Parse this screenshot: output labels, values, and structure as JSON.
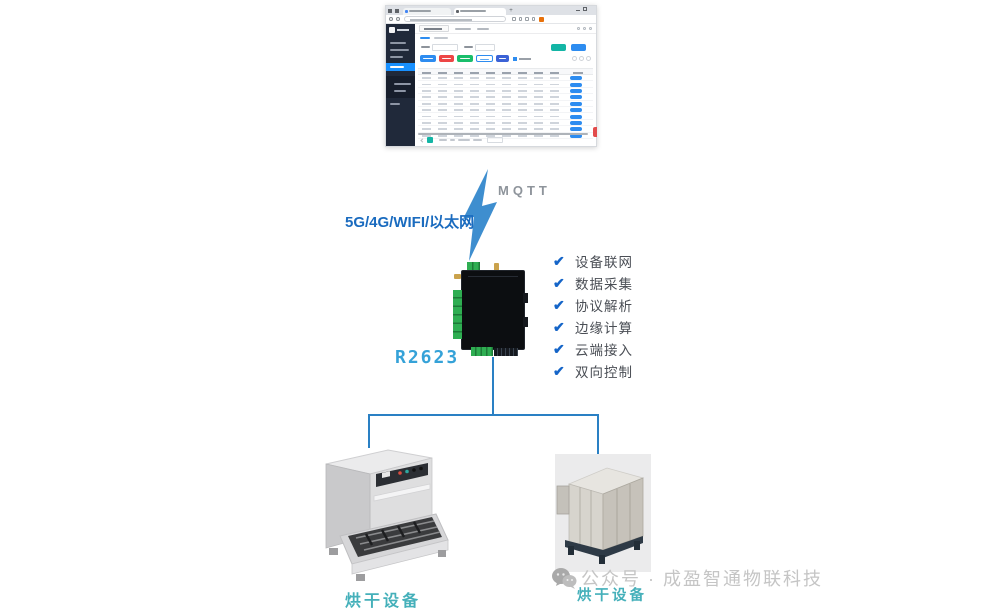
{
  "connection": {
    "protocol_label": "MQTT",
    "link_label": "5G/4G/WIFI/以太网"
  },
  "gateway": {
    "model": "R2623",
    "features": [
      "设备联网",
      "数据采集",
      "协议解析",
      "边缘计算",
      "云端接入",
      "双向控制"
    ]
  },
  "devices": {
    "left_label": "烘干设备",
    "right_label": "烘干设备"
  },
  "watermark": {
    "text": "公众号 · 成盈智通物联科技"
  },
  "icons": {
    "lightning": "lightning-bolt-icon",
    "check": "check-icon",
    "wechat": "wechat-icon"
  },
  "colors": {
    "connector_blue": "#2a80c4",
    "link_label_blue": "#1a6bbf",
    "mqtt_gray": "#8e949b",
    "check_blue": "#1565c8",
    "feature_text": "#4a4e55",
    "gateway_label_blue": "#35a2d8",
    "device_label_teal": "#45b0ba",
    "watermark_gray": "#c5c5c5",
    "sidebar_dark": "#20293a",
    "active_menu_blue": "#1890ff",
    "button_blue": "#2d8cf0",
    "button_red": "#ed4646",
    "button_green": "#19be6b",
    "button_teal": "#13b5a5",
    "terminal_green": "#2fae52"
  }
}
